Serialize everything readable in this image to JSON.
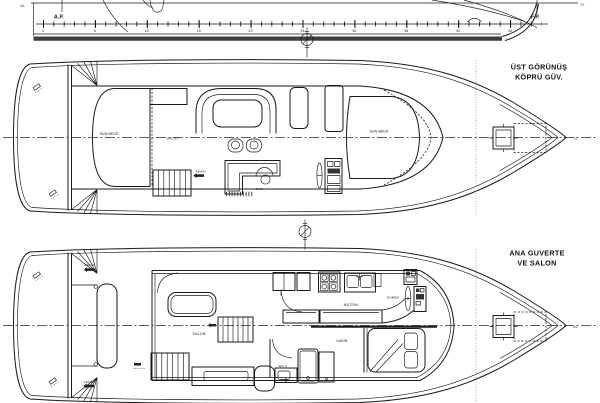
{
  "profile": {
    "dl_left": "DL",
    "dl_right": "DL",
    "ap_label": "A.P.",
    "fp_label": "F.P.",
    "ruler_labels": [
      "0",
      "5",
      "10",
      "15",
      "20",
      "25",
      "30",
      "35",
      "40",
      "45"
    ]
  },
  "upper_deck": {
    "title_line1": "ÜST GÖRÜNÜŞ",
    "title_line2": "KÖPRÜ GÜV.",
    "labels": {
      "sunbeds_left": "SUN-BEDS",
      "jakuzi": "JAKUZİ",
      "bar": "BAR",
      "sunbeds_right": "SUN-BEDS",
      "stairs_down": "AŞAĞI",
      "dl": "DL"
    }
  },
  "lower_deck": {
    "title_line1": "ANA GUVERTE",
    "title_line2": "VE SALON",
    "labels": {
      "salon": "SALON",
      "mutfak": "MUTFAK",
      "dumen": "DÜMEN",
      "kabin": "KABİN",
      "wc": "WC 4",
      "stairs_down_top": "AŞAĞI",
      "stairs_down_bottom": "AŞAĞI",
      "dl": "DL"
    }
  }
}
